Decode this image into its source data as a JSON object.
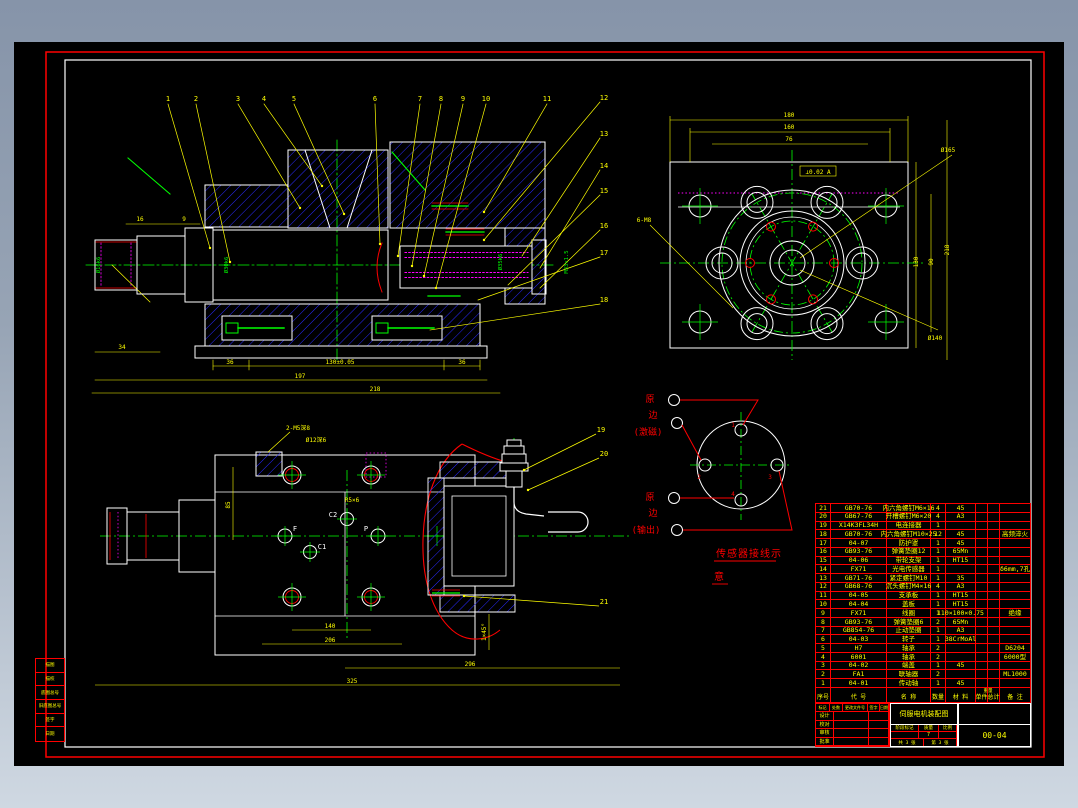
{
  "background": {
    "top_color": "#8694a9",
    "bottom_color": "#cfd8e2"
  },
  "sheet": {
    "bg": "#000000",
    "border_color": "#ff0000",
    "inner_frame_color": "#ffffff"
  },
  "palette": {
    "outline": "#ffffff",
    "hatch": "#2a2aff",
    "centerline": "#00ff00",
    "dimension": "#ffff00",
    "detail_red": "#ff0000",
    "hidden_magenta": "#ff00ff"
  },
  "callouts": [
    "1",
    "2",
    "3",
    "4",
    "5",
    "6",
    "7",
    "8",
    "9",
    "10",
    "11",
    "12",
    "13",
    "14",
    "15",
    "16",
    "17",
    "18",
    "19",
    "20",
    "21"
  ],
  "viewA": {
    "dim_16": "16",
    "dim_9": "9",
    "dim_34": "34",
    "dim_36_left": "36",
    "dim_130": "130±0.05",
    "dim_36_right": "36",
    "dim_197": "197",
    "dim_218": "218",
    "shaft_dim_1": "Ø16k6",
    "shaft_dim_2": "Ø30k6",
    "shaft_dim_3": "Ø35k6",
    "shaft_dim_4": "M33×1.5"
  },
  "viewB": {
    "dim_180": "180",
    "dim_160": "160",
    "dim_76": "76",
    "dim_130": "130",
    "dim_90": "90",
    "dim_218": "218",
    "label_d165": "Ø165",
    "label_d140": "Ø140",
    "label_6m8": "6-M8",
    "tolerance": "⊥0.02 A"
  },
  "viewC": {
    "port_f": "F",
    "port_c1": "C1",
    "port_c2": "C2",
    "port_p": "P",
    "note_1": "2-M5深8",
    "note_2": "Ø12深6",
    "note_3": "R5×6",
    "dim_85": "85",
    "dim_140": "140",
    "dim_206": "206",
    "dim_296": "296",
    "dim_325": "325",
    "dim_chamfer": "1×45°"
  },
  "wiring": {
    "terminals": [
      "1",
      "2",
      "3",
      "4"
    ],
    "primary_line1": "原",
    "primary_line2": "边",
    "primary_line3": "(激磁)",
    "secondary_line1": "原",
    "secondary_line2": "边",
    "secondary_line3": "(输出)",
    "caption_line1": "传感器接线示",
    "caption_line2": "意"
  },
  "bom": {
    "headers": [
      "序号",
      "代  号",
      "名  称",
      "数量",
      "材  料",
      "单件",
      "总计",
      "备  注"
    ],
    "weight_label": "重量",
    "rows": [
      [
        "21",
        "GB70-76",
        "内六角螺钉M6×16",
        "4",
        "45",
        "",
        "",
        ""
      ],
      [
        "20",
        "GB67-76",
        "开槽螺钉M6×20",
        "4",
        "A3",
        "",
        "",
        ""
      ],
      [
        "19",
        "X14K3FL34H",
        "电连接器",
        "1",
        "",
        "",
        "",
        ""
      ],
      [
        "18",
        "GB70-76",
        "内六角螺钉M10×25",
        "12",
        "45",
        "",
        "",
        "高频淬火"
      ],
      [
        "17",
        "04-07",
        "防护罩",
        "1",
        "45",
        "",
        "",
        ""
      ],
      [
        "16",
        "GB93-76",
        "弹簧垫圈12",
        "1",
        "65Mn",
        "",
        "",
        ""
      ],
      [
        "15",
        "04-06",
        "带轮支架",
        "1",
        "HT15",
        "",
        "",
        ""
      ],
      [
        "14",
        "FX71",
        "光电传感器",
        "1",
        "",
        "",
        "",
        "δ6mm,7孔"
      ],
      [
        "13",
        "GB71-76",
        "紧定螺钉M10",
        "1",
        "35",
        "",
        "",
        ""
      ],
      [
        "12",
        "GB68-76",
        "沉头螺钉M4×16",
        "4",
        "A3",
        "",
        "",
        ""
      ],
      [
        "11",
        "04-05",
        "支承板",
        "1",
        "HT15",
        "",
        "",
        ""
      ],
      [
        "10",
        "04-04",
        "盖板",
        "1",
        "HT15",
        "",
        "",
        ""
      ],
      [
        "9",
        "FX71",
        "线圈",
        "1",
        "110×100×0.75",
        "",
        "",
        "绝缘"
      ],
      [
        "8",
        "GB93-76",
        "弹簧垫圈6",
        "2",
        "65Mn",
        "",
        "",
        ""
      ],
      [
        "7",
        "GB854-76",
        "止动垫圈",
        "1",
        "A3",
        "",
        "",
        ""
      ],
      [
        "6",
        "04-03",
        "转子",
        "1",
        "38CrMoAl",
        "",
        "",
        ""
      ],
      [
        "5",
        "H7",
        "轴承",
        "2",
        "",
        "",
        "",
        "D6204"
      ],
      [
        "4",
        "6001",
        "轴承",
        "2",
        "",
        "",
        "",
        "6000型"
      ],
      [
        "3",
        "04-02",
        "端盖",
        "1",
        "45",
        "",
        "",
        ""
      ],
      [
        "2",
        "FA1",
        "联轴器",
        "2",
        "",
        "",
        "",
        "ML1000"
      ],
      [
        "1",
        "04-01",
        "传动轴",
        "1",
        "45",
        "",
        "",
        ""
      ]
    ]
  },
  "titleblock": {
    "change_row": [
      "标记",
      "处数",
      "更改文件号",
      "签字",
      "日期"
    ],
    "sign_labels": [
      "设计",
      "校对",
      "审核",
      "批准"
    ],
    "title": "伺服电机装配图",
    "stage_label": "阶段标记",
    "mass_label": "质量",
    "scale_label": "比例",
    "mass_value": "7",
    "sheet_total": "共 3 张",
    "sheet_no": "第 3 张",
    "drawing_no": "00-04"
  },
  "left_strip": [
    "描图",
    "描校",
    "底图总号",
    "旧底图总号",
    "签字",
    "日期"
  ]
}
